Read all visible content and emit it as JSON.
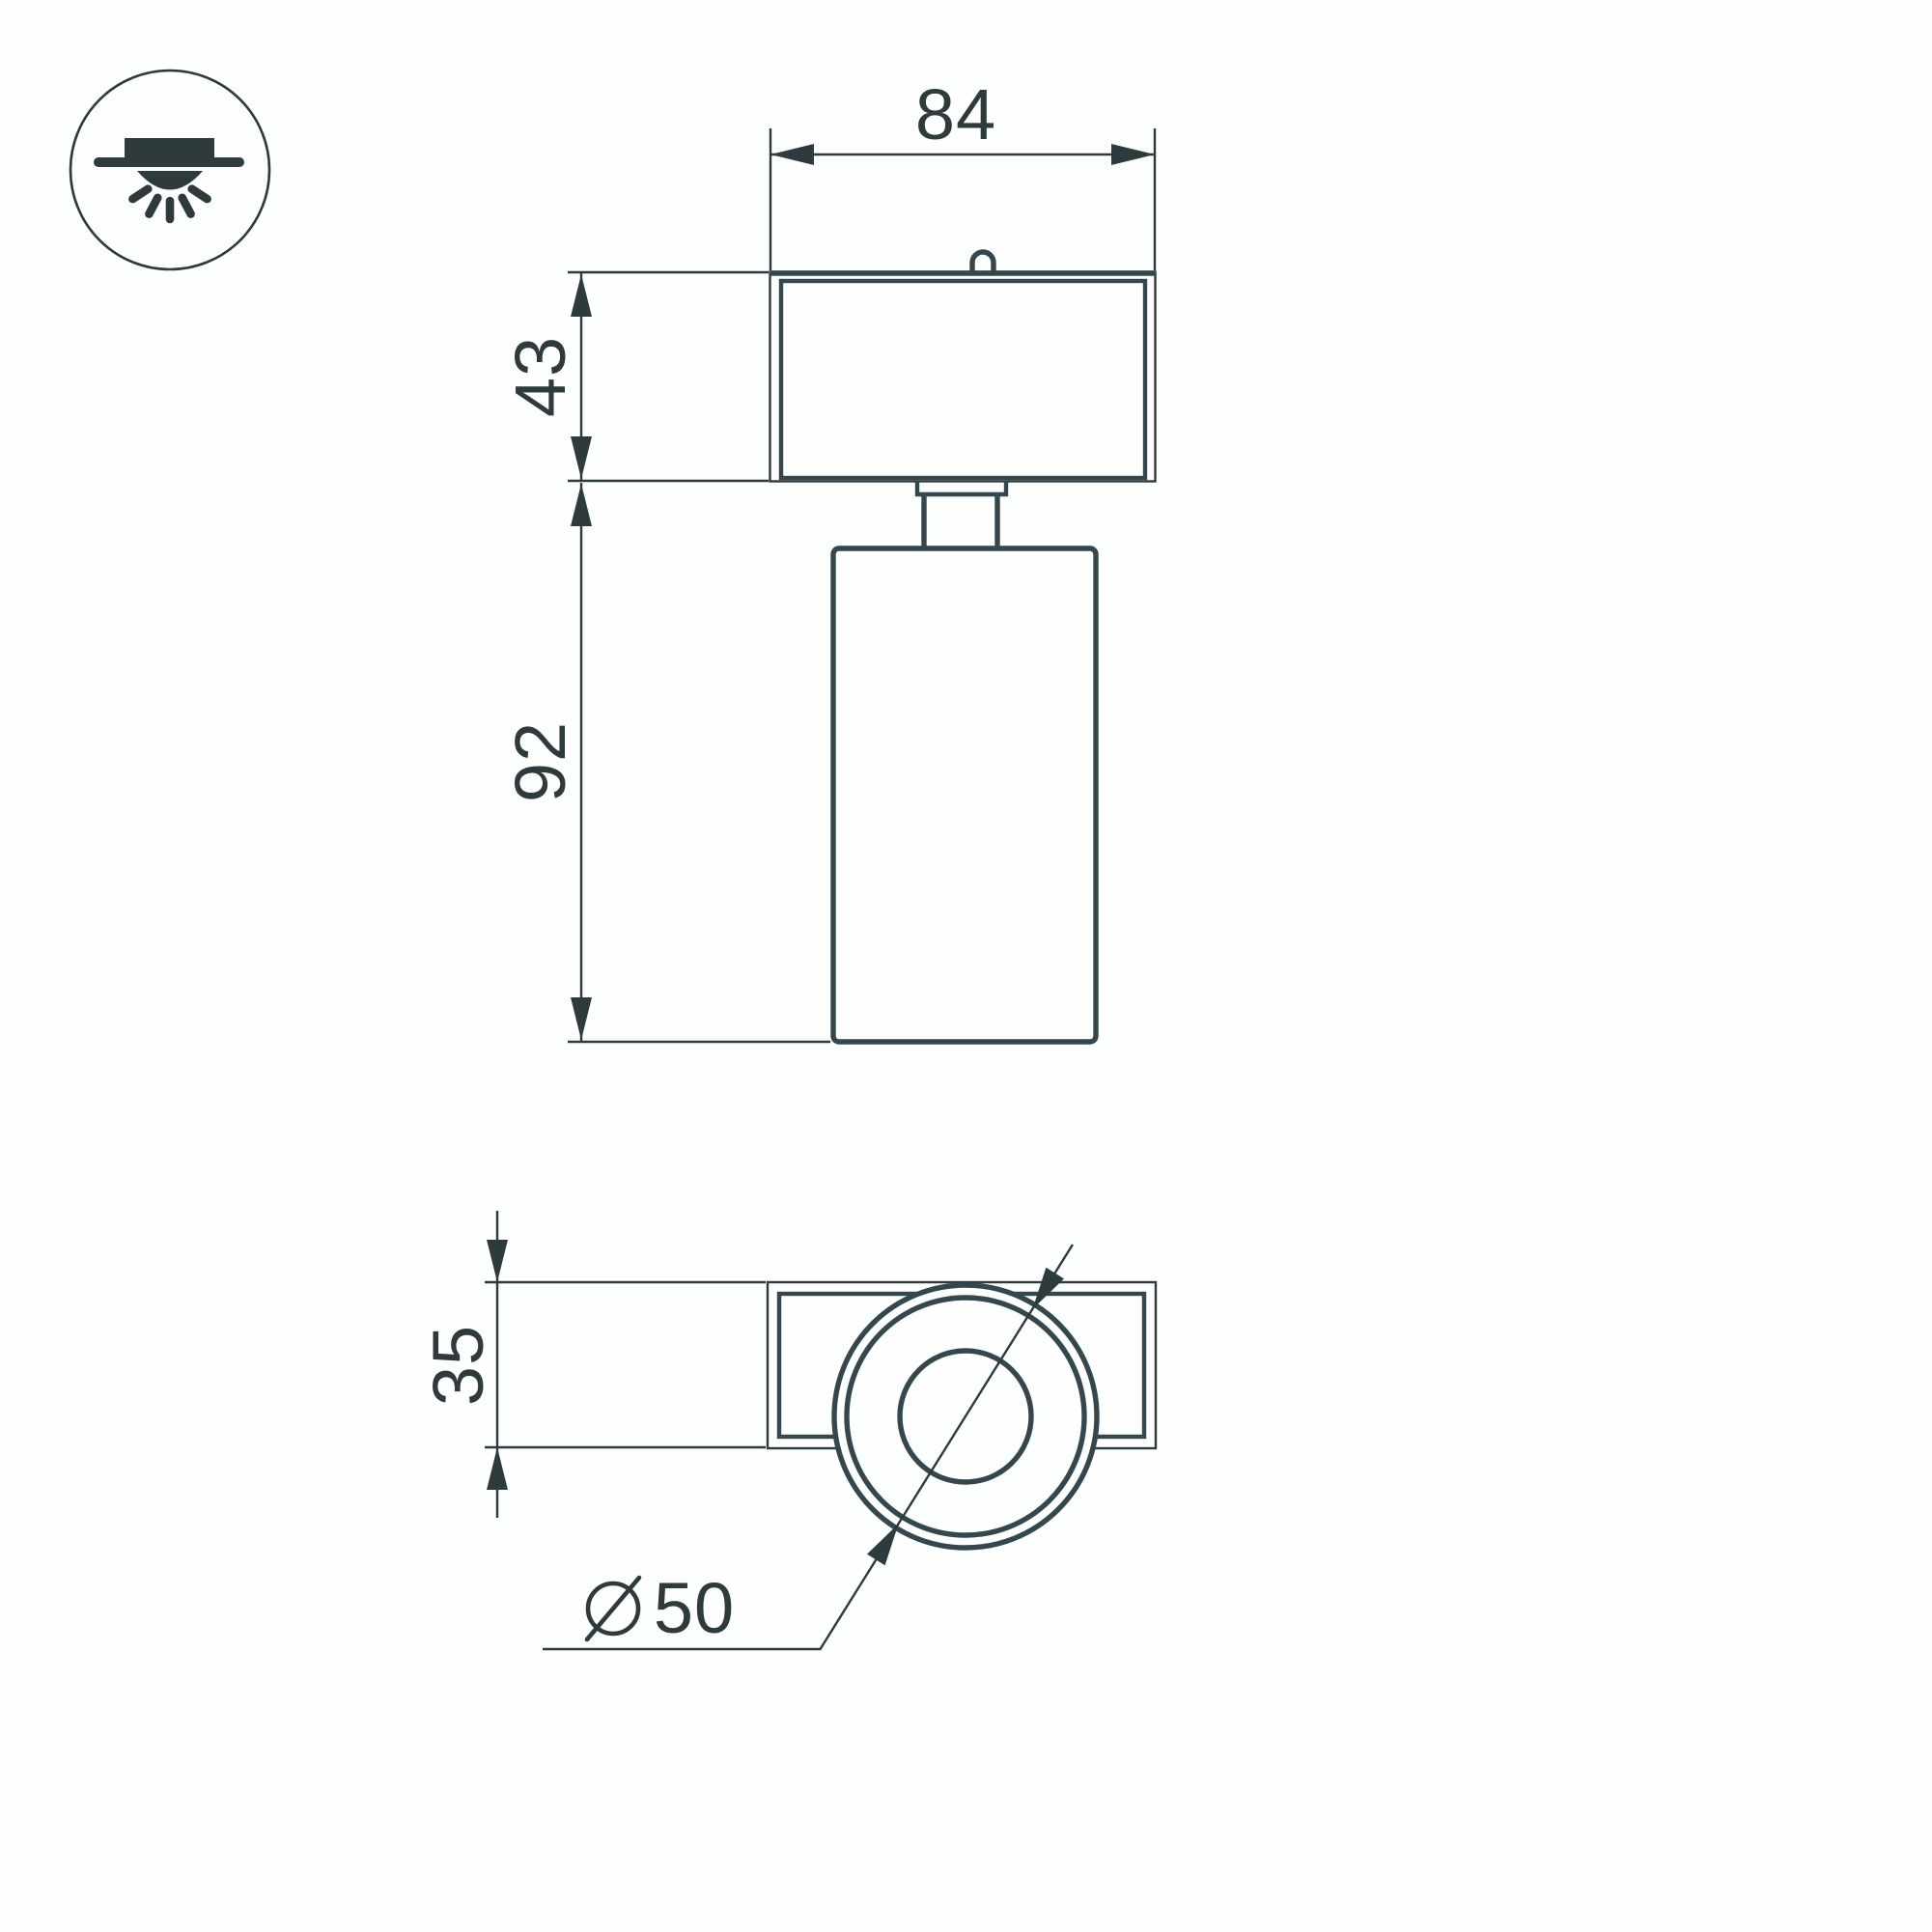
{
  "palette": {
    "ink": "#2e3a3c",
    "ink_soft": "#35474c",
    "bg": "#fdfefe"
  },
  "icon": {
    "name": "surface-mounted-downlight-icon"
  },
  "views": {
    "front_view_name": "front-view",
    "bottom_view_name": "bottom-view"
  },
  "dims": {
    "width": "84",
    "head_height": "43",
    "body_height": "92",
    "base_depth": "35",
    "lens_diameter": "50",
    "diameter_symbol": "diameter-symbol"
  }
}
